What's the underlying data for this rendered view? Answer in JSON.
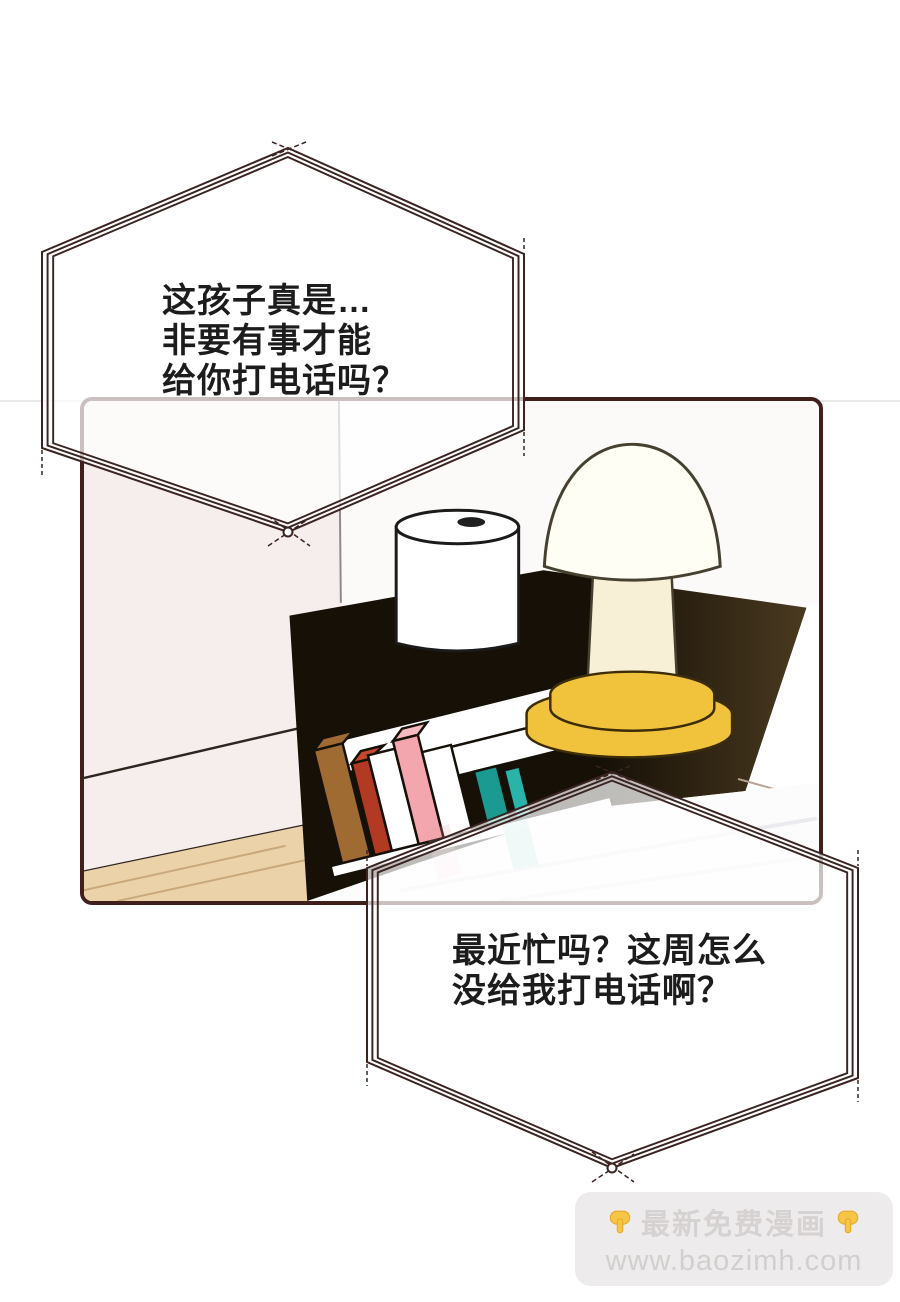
{
  "comic": {
    "bubbles": {
      "top": {
        "lines": [
          "这孩子真是…",
          "非要有事才能",
          "给你打电话吗？"
        ]
      },
      "bottom": {
        "lines": [
          "最近忙吗？这周怎么",
          "没给我打电话啊？"
        ]
      }
    },
    "watermark": {
      "title": "最新免费漫画",
      "url": "www.baozimh.com"
    },
    "colors": {
      "outline": "#3a2321",
      "bubble_fill": "rgba(255,255,255,0.72)",
      "panel_border": "#401f1c",
      "wall_pink": "#f6eded",
      "wall_white": "#fcfaf9",
      "floor_tan": "#ecd2a9",
      "nightstand_dark": "#161007",
      "nightstand_light": "#4a3a20",
      "lamp_cap": "#fffef4",
      "lamp_stem": "#f7f0d6",
      "lamp_yellow": "#f1c23b",
      "book_brown": "#a06a33",
      "book_red": "#b23a22",
      "book_pink": "#f3a6ad",
      "book_teal": "#1a9a91",
      "book_teal2": "#2ab3a8",
      "hand_yellow": "#f6c544"
    }
  }
}
